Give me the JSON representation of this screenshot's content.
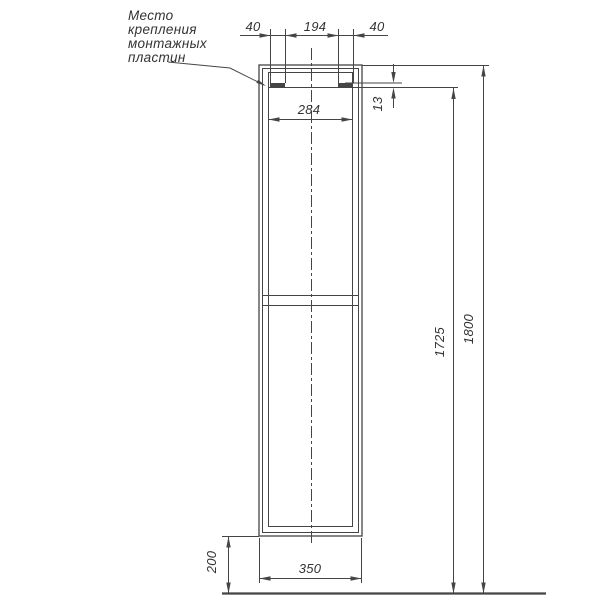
{
  "drawing": {
    "note": {
      "line1": "Место",
      "line2": "крепления",
      "line3": "монтажных",
      "line4": "пластин"
    },
    "dims": {
      "plate_offset_left": "40",
      "plate_spacing": "194",
      "plate_offset_right": "40",
      "opening_width": "284",
      "plate_height": "13",
      "mount_height": "1725",
      "total_height": "1800",
      "base_height": "200",
      "cabinet_width": "350"
    },
    "colors": {
      "line": "#454545",
      "background": "#ffffff"
    }
  }
}
